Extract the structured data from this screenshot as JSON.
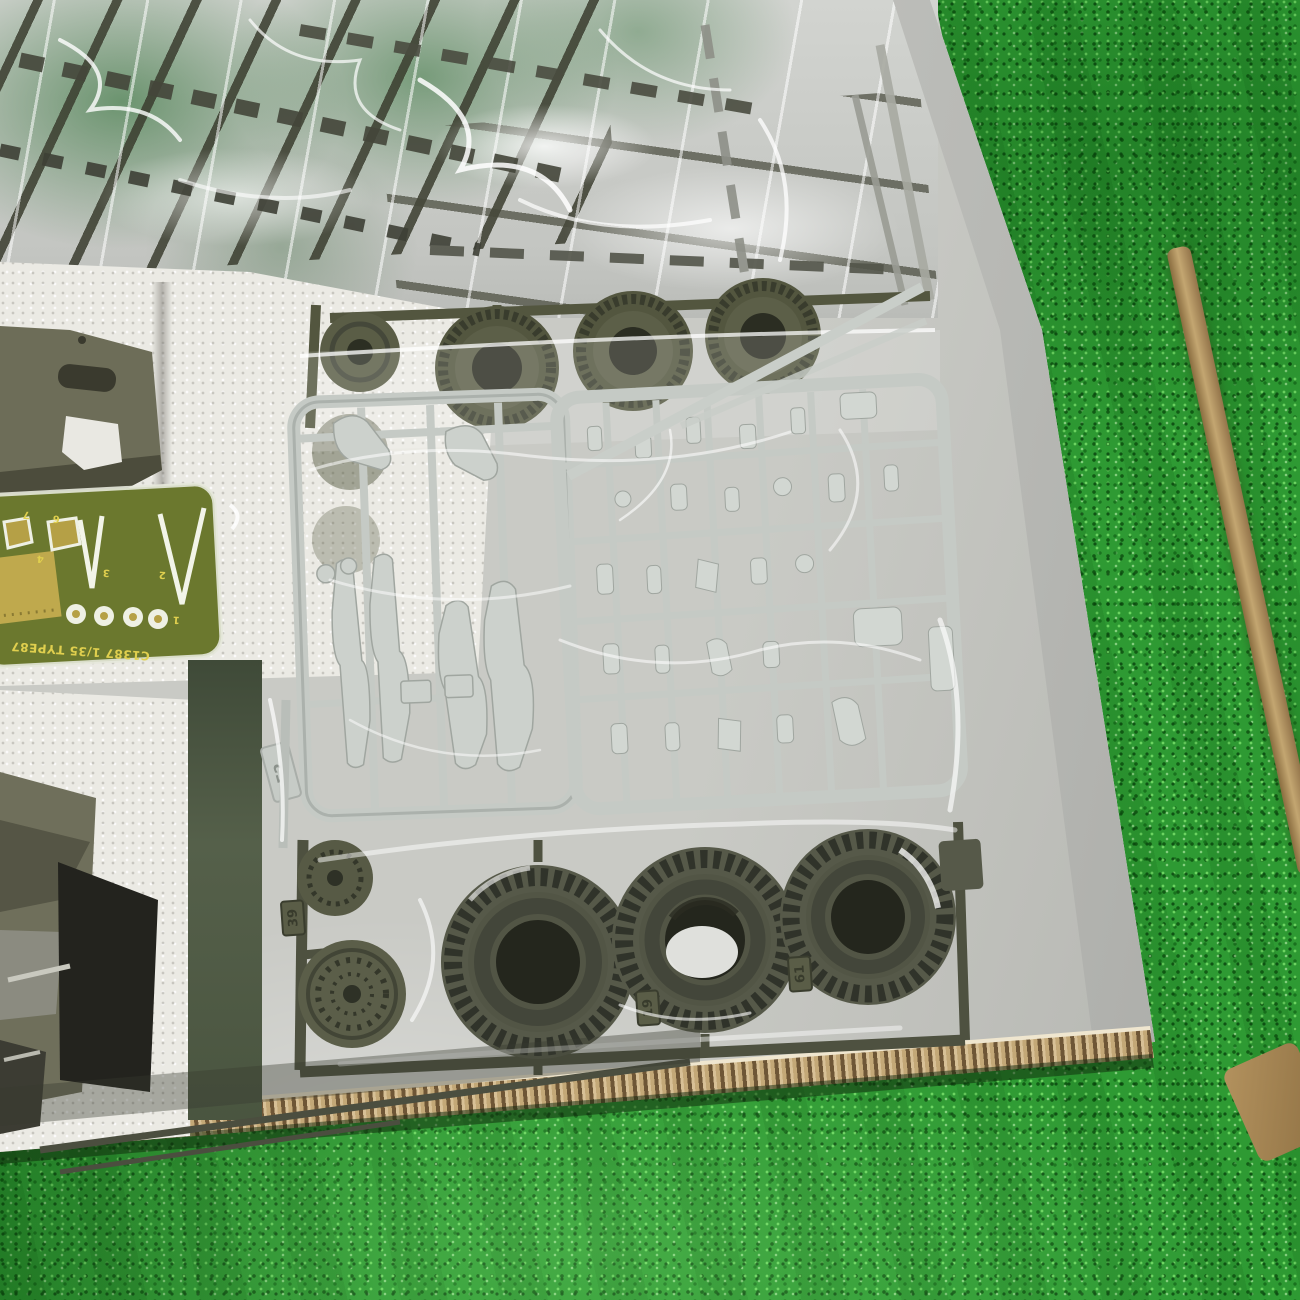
{
  "photo": {
    "title": "Opened 1/35 model kit box with sprues on artificial grass",
    "labels": {
      "pe_code": "C1387 1/35 TYPE87",
      "pe_numbers": [
        "1",
        "2",
        "3",
        "4",
        "6",
        "7"
      ],
      "tag_figure_sprue": "F2",
      "tag_wheel_left": "39",
      "tag_wheel_mid": "19",
      "tag_wheel_right": "61"
    },
    "colors": {
      "grass_base": "#2e9a33",
      "grass_dark": "#156e1f",
      "grass_light": "#7fdf6e",
      "grass_seam_tan": "#b79a64",
      "cardboard_light": "#d7c096",
      "cardboard_dark": "#6e5636",
      "box_floor": "#c6c7c1",
      "box_wall": "#c2c3bf",
      "foam_white": "#ebeae4",
      "olive_sprue": "#565944",
      "olive_dark": "#2e3126",
      "gray_sprue": "#c7ccc8",
      "pe_board_green": "#6b782e",
      "pe_brass": "#c2ab4f",
      "pe_text_yellow": "#e0cf4e",
      "bag_highlight": "#ffffff"
    }
  }
}
